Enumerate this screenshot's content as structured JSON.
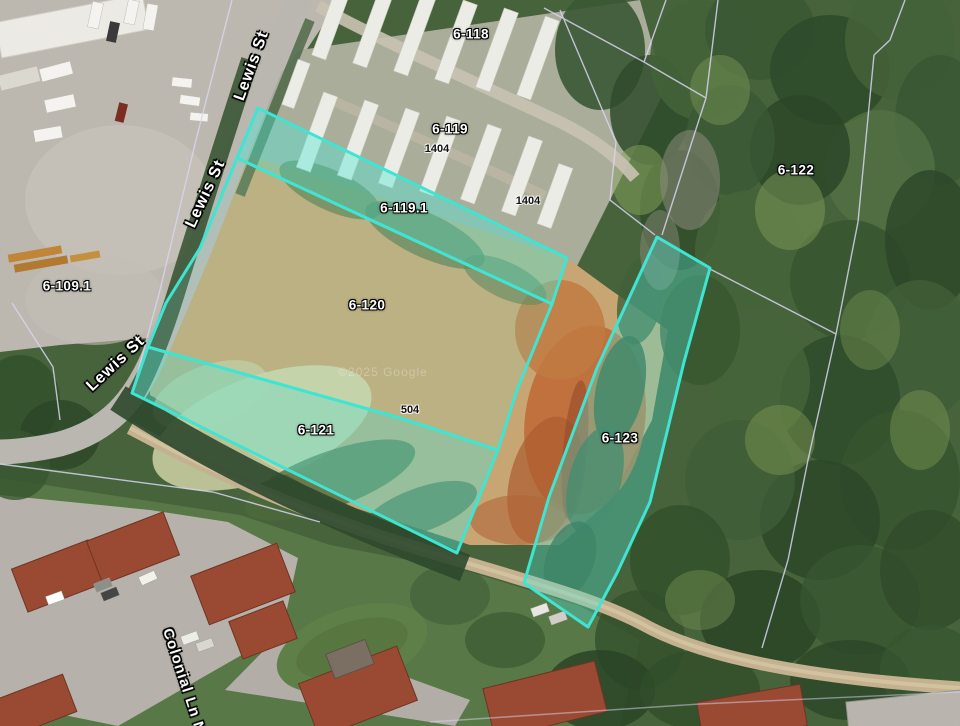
{
  "map": {
    "type": "satellite-parcel-viewer",
    "watermark": "©2025 Google",
    "highlight_color": "#40E4D2",
    "boundary_color": "#D9D4F2"
  },
  "parcels": [
    {
      "id": "6-109.1",
      "label": "6-109.1",
      "highlighted": false
    },
    {
      "id": "6-118",
      "label": "6-118",
      "highlighted": false
    },
    {
      "id": "6-119",
      "label": "6-119",
      "highlighted": false
    },
    {
      "id": "6-119.1",
      "label": "6-119.1",
      "highlighted": true
    },
    {
      "id": "6-120",
      "label": "6-120",
      "highlighted": true
    },
    {
      "id": "6-121",
      "label": "6-121",
      "highlighted": true
    },
    {
      "id": "6-122",
      "label": "6-122",
      "highlighted": false
    },
    {
      "id": "6-123",
      "label": "6-123",
      "highlighted": true
    }
  ],
  "addresses": [
    {
      "label": "1404"
    },
    {
      "label": "1404"
    },
    {
      "label": "504"
    }
  ],
  "streets": [
    {
      "label": "Lewis St"
    },
    {
      "label": "Lewis St"
    },
    {
      "label": "Lewis St"
    },
    {
      "label": "Colonial Ln N"
    }
  ]
}
